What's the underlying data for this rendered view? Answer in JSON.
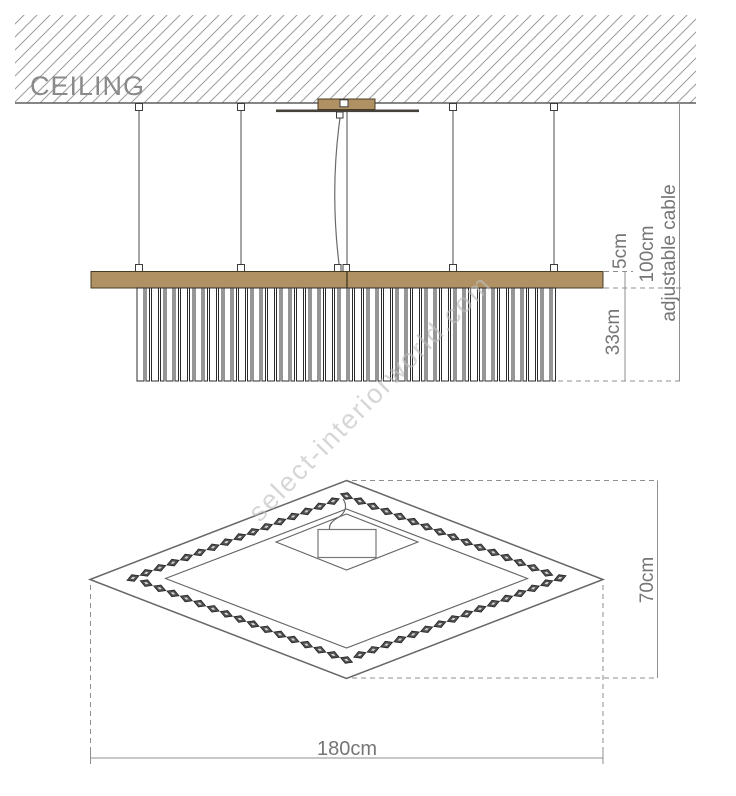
{
  "watermark": {
    "text": "select-interiorworld.com"
  },
  "front_view": {
    "ceiling_label": "CEILING",
    "dimensions": {
      "frame_thickness": "5cm",
      "cable_length": "100cm",
      "cable_note": "adjustable cable",
      "fringe_length": "33cm"
    }
  },
  "plan_view": {
    "dimensions": {
      "depth": "70cm",
      "width": "180cm"
    }
  },
  "colors": {
    "wood": "#b09163",
    "wood_edge": "#4a3b24",
    "line": "#666666",
    "dim_line": "#8f8f8f",
    "dim_text": "#767676",
    "ceiling_text": "#8a8a8a",
    "hatch": "#9d9d9d",
    "bead": "#4f4f4f",
    "bead_core": "#d4d4d4",
    "watermark": "#bdbdbd"
  }
}
